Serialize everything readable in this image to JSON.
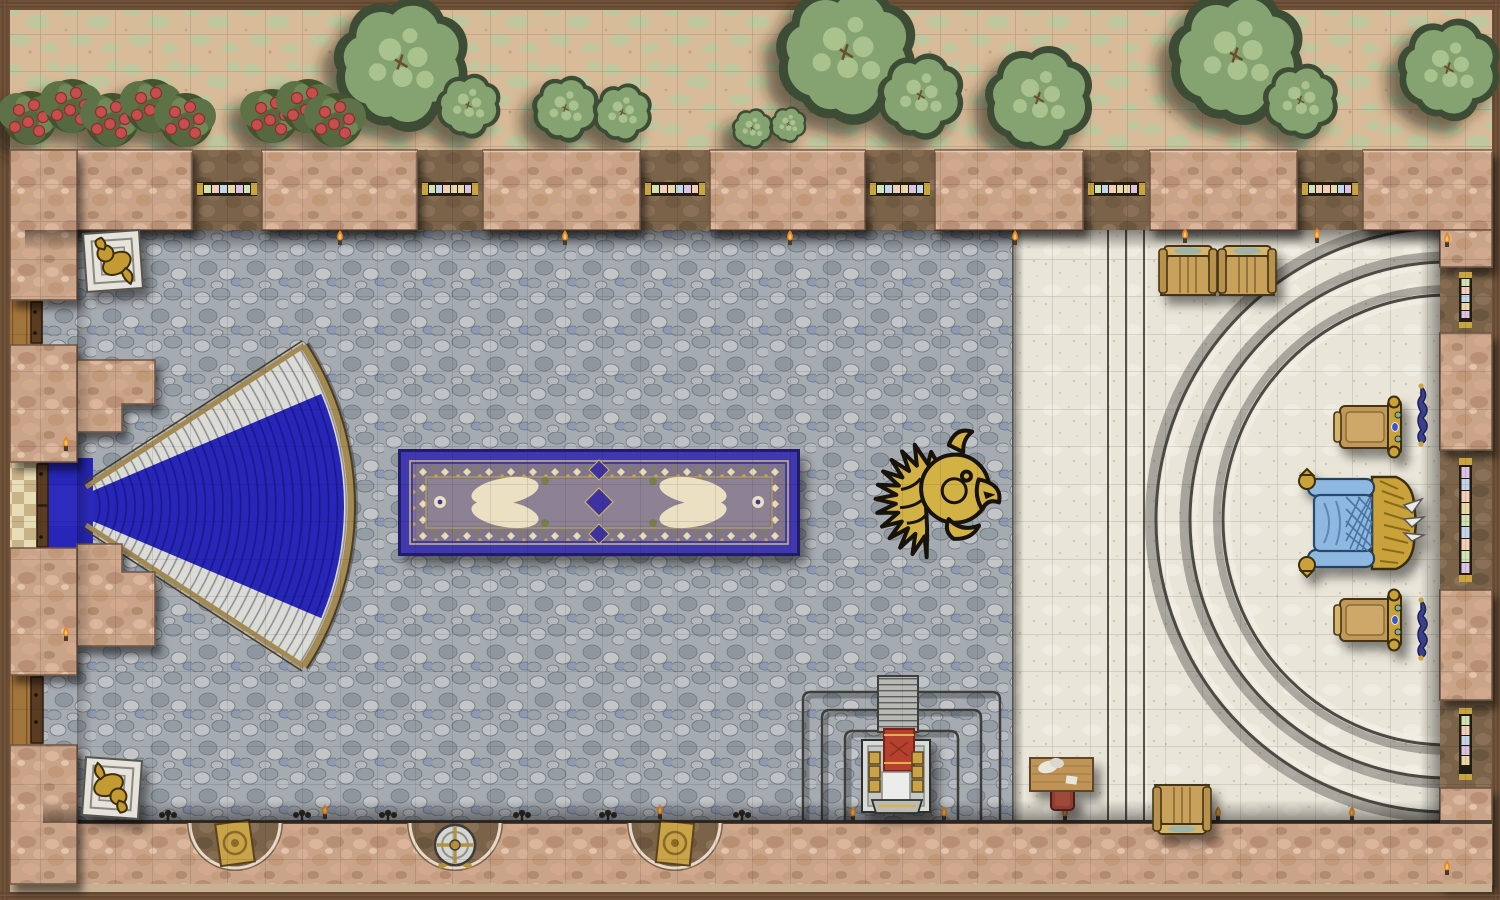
{
  "map": {
    "title": "Throne Room Battle Map",
    "type": "top-down fantasy battle map",
    "grid": {
      "columns": 40,
      "rows": 24,
      "cell_px": 37.5,
      "line_color": "rgba(20,20,30,0.22)"
    }
  },
  "palette": {
    "frame_wood": "#6f5138",
    "garden_ground": "#d8bb98",
    "garden_moss": "#bcc89e",
    "tree_green": "#84a371",
    "tree_dark": "#3e4d34",
    "rose_red": "#c6504e",
    "wall_stone": "#c9a488",
    "wall_recess": "#7b6349",
    "hall_floor": "#a6abb1",
    "dais_floor": "#e9e5d8",
    "carpet_blue": "#2726b8",
    "carpet_border_blue": "#4038b0",
    "carpet_field": "#8d8294",
    "stair_white": "#dcdcd7",
    "stair_trim": "#a38a52",
    "gold": "#d3b245",
    "throne_gold": "#c9a23a",
    "throne_cushion": "#8fb8e0",
    "chair_wood": "#c8a25c",
    "desk_wood": "#bf9457",
    "desk_chair_red": "#8e3c2e",
    "altar_cloth_red": "#b5402f",
    "banner_blue": "#3a3f8e",
    "window_frame_gold": "#c9a53f",
    "window_pane_mint": "#cfe3b5",
    "window_pane_peach": "#f2cdb9",
    "window_pane_blue": "#c3d7ea",
    "window_pane_cream": "#ead9a8",
    "window_pane_lavender": "#dcc3e6",
    "flame_orange": "#e8862a"
  },
  "features": {
    "garden": {
      "label": "garden strip with trees and rose hedges",
      "tree_count": 7,
      "rose_hedge_clusters": 2
    },
    "outer_wall": {
      "label": "pink stone outer wall",
      "top_window_count": 6,
      "right_window_count": 3,
      "window_style": "stained glass, pastel panes with gold caps"
    },
    "great_hall": {
      "label": "great hall with gray cobblestone floor"
    },
    "grand_staircase": {
      "label": "fan-shaped grand staircase with royal blue carpet",
      "orientation": "flaring east from west double door"
    },
    "entry_doors": {
      "label": "west double door with mosaic vestibule",
      "side_doors": 2
    },
    "ornamental_carpet": {
      "label": "rectangular ornamental carpet, blue border with cream medallions"
    },
    "floor_emblem": {
      "label": "gold heraldic beast-head inlay on hall floor"
    },
    "dais": {
      "label": "white marble dais with three curved steps",
      "arc_steps": 3
    },
    "throne": {
      "label": "gold throne with blue cushions facing west"
    },
    "side_chairs": {
      "label": "two gilded side chairs flanking the throne",
      "count": 2
    },
    "wooden_chairs": {
      "label": "plain wooden chairs on the dais",
      "count": 3
    },
    "writing_desk": {
      "label": "wooden desk with papers and red chair"
    },
    "altar": {
      "label": "stepped altar platform with red-draped shrine at south wall"
    },
    "statues": {
      "label": "gold statues on square pedestals",
      "count": 2
    },
    "wall_niches": {
      "label": "three alcoves in south wall",
      "items": [
        "gold plaque",
        "round shield with crossed axes",
        "gold plaque"
      ]
    },
    "wall_banners": {
      "label": "blue wall hangings behind the side chairs",
      "count": 2
    },
    "torches": {
      "label": "wall torches and candelabra along walls"
    }
  }
}
